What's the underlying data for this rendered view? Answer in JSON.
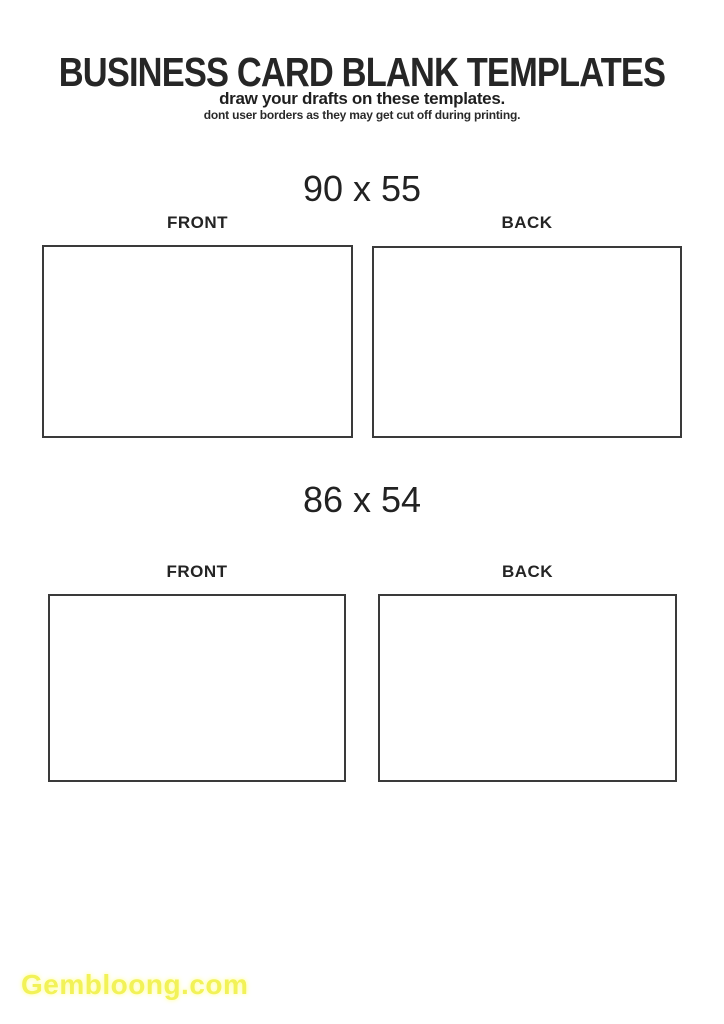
{
  "page": {
    "background": "#ffffff",
    "text_color": "#2b2b2b",
    "card_border_color": "#3a3a3a"
  },
  "header": {
    "title": "BUSINESS CARD BLANK TEMPLATES",
    "subtitle": "draw your drafts on these templates.",
    "note": "dont user borders as they may get cut off during printing."
  },
  "sections": [
    {
      "size_label": "90 x 55",
      "front_label": "FRONT",
      "back_label": "BACK"
    },
    {
      "size_label": "86 x 54",
      "front_label": "FRONT",
      "back_label": "BACK"
    }
  ],
  "watermark": {
    "text": "Gembloong.com",
    "color": "#f2f258"
  }
}
